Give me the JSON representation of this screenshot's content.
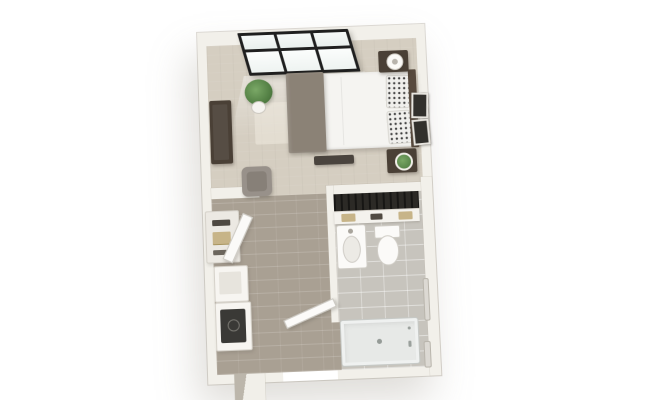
{
  "page": {
    "background": "#ffffff",
    "description": "3D top-down dollhouse floor plan of a studio apartment with bedroom/living area, kitchenette entry and bathroom"
  },
  "palette": {
    "wall": "#f2f0ea",
    "wall_shadow": "#c9c4ba",
    "bedroom_floor": "#d5cec1",
    "corridor_floor": "#a9a093",
    "bathroom_floor": "#c7c4bd",
    "window_frame": "#1f1f1f",
    "window_glass": "#f3f7f6",
    "dark_wood": "#4a4036",
    "blanket_gray": "#8b8276",
    "duvet_white": "#f5f4f1",
    "armchair_gray": "#98918a",
    "plant_green": "#5d8c4c",
    "fixture_white": "#fbfaf8",
    "shower_gray": "#e7e9e7",
    "closet_dark": "#2c2a26",
    "linen_tan": "#c7b488"
  },
  "rooms": {
    "bedroom": {
      "label": "Bedroom / living area",
      "items": {
        "window": "Black-framed triple window",
        "plant": "Potted floor plant",
        "dresser": "Dark wood dresser / media console",
        "chair": "Gray armchair",
        "rug": "Area rug",
        "bed": "Bed with white duvet and gray throw",
        "pillows": "Patterned pillows",
        "headboard": "Headboard against right wall",
        "nightstand_top": "Nightstand with lamp",
        "nightstand_bottom": "Nightstand with plant",
        "bench": "Bench at foot of bed",
        "wall_art": "Framed wall art"
      }
    },
    "kitchenette": {
      "label": "Kitchenette / entry hall",
      "items": {
        "pantry": "Pantry shelves with linens",
        "cabinet_door": "Open cabinet door",
        "counter": "White counter",
        "stove": "Range with dark cooktop",
        "entry_door": "Entry door shown open"
      }
    },
    "bathroom": {
      "label": "Bathroom",
      "items": {
        "closet": "Closet with hanging clothes and shelf",
        "shelf_items": "Folded linens on closet shelf",
        "sink": "Pedestal sink",
        "toilet": "Toilet",
        "grab_bar": "Wall grab bar",
        "towel_bar": "Towel bar",
        "shower": "Roll-in shower with center drain"
      }
    }
  }
}
